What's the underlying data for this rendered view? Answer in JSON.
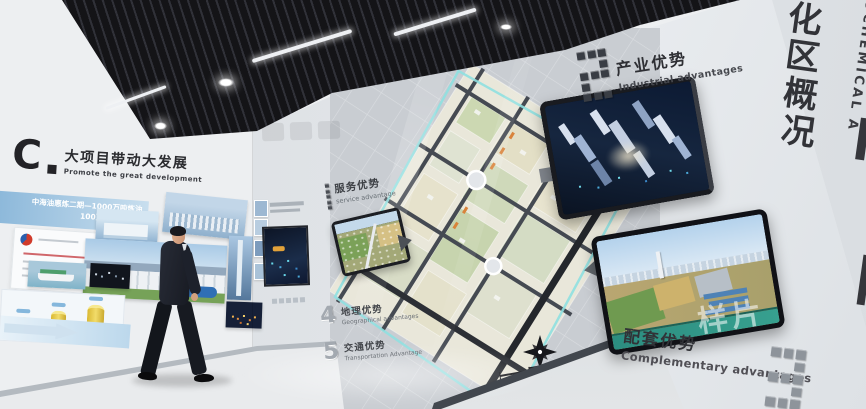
{
  "watermark": {
    "text": "样片"
  },
  "right_corner_sign": {
    "zh_chars": [
      "化",
      "区",
      "概",
      "况"
    ],
    "en_vertical": "OCHEMICAL A"
  },
  "industrial_section": {
    "number": "2",
    "title_zh": "产业优势",
    "title_en": "Industrial advantages"
  },
  "complementary_section": {
    "number": "3",
    "title_zh": "配套优势",
    "title_en": "Complementary advantages"
  },
  "left_wall": {
    "logo_letter": "C",
    "title_zh": "大项目带动大发展",
    "title_en": "Promote the great development",
    "banner_line1": "中海油惠炼二期—1000万吨炼油",
    "banner_line2": "100万吨乙烯"
  },
  "map_items": [
    {
      "number": "1",
      "zh": "服务优势",
      "en": "service advantage"
    },
    {
      "number": "4",
      "zh": "地理优势",
      "en": "Geographical advantages"
    },
    {
      "number": "5",
      "zh": "交通优势",
      "en": "Transportation Advantage"
    }
  ],
  "colors": {
    "accent_cyan": "#8fe0e0",
    "ceiling_black": "#141417",
    "map_base": "#c8ccd1"
  }
}
